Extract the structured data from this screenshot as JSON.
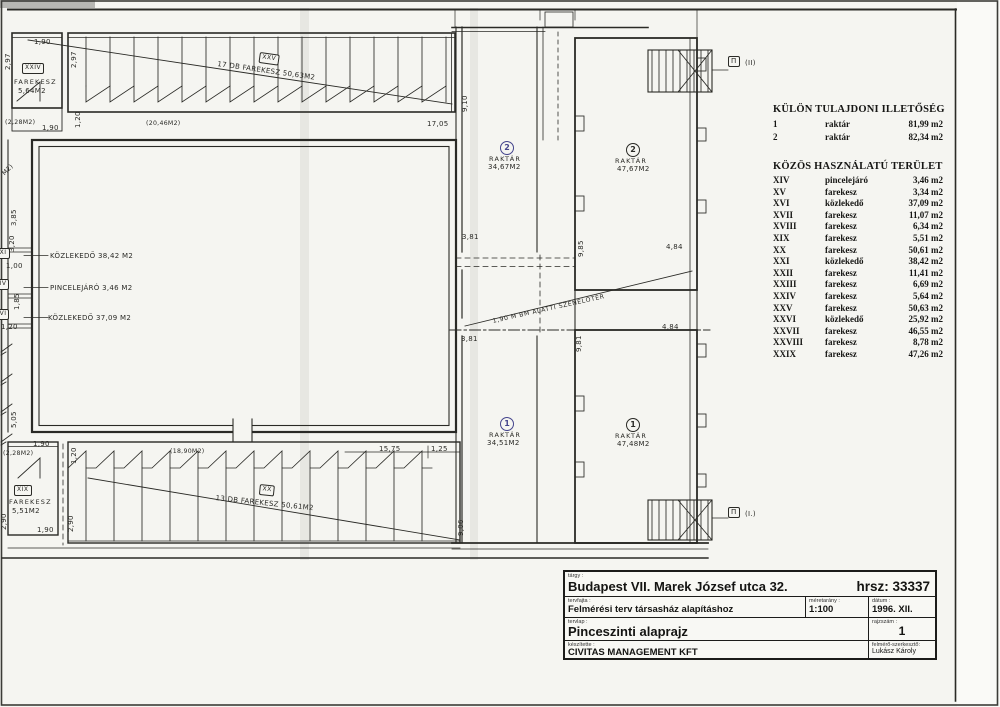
{
  "colors": {
    "paper": "#f5f5f1",
    "ink": "#2a2a26",
    "blue_ink": "#44448c"
  },
  "plan": {
    "dims": {
      "tl_297a": "2,97",
      "tl_190a": "1,90",
      "tl_297b": "2,97",
      "tl_120": "1,20",
      "tl_228": "(2,28M2)",
      "tl_190b": "1,90",
      "tl_2046": "(20,46M2)",
      "tl_1705": "17,05",
      "lm_385": "3,85",
      "lm_320": "3,20",
      "lm_100": "1,00",
      "lm_185": "1,85",
      "lm_120": "1,20",
      "lm_505": "5,05",
      "lm_part": "M2)",
      "bl_190a": "1,90",
      "bl_228": "(2,28M2)",
      "bl_120": "1,20",
      "bl_290a": "2,90",
      "bl_190b": "1,90",
      "bl_290b": "2,90",
      "bl_1890": "(18,90M2)",
      "bl_1575": "15,75",
      "bl_125": "1,25",
      "m_910": "9,10",
      "m_381a": "3,81",
      "m_985": "9,85",
      "m_484a": "4,84",
      "m_381b": "3,81",
      "m_981": "9,81",
      "m_484b": "4,84",
      "m_906": "9,06"
    },
    "rooms": {
      "xxiv": {
        "id": "XXIV",
        "name": "FAREKESZ",
        "area": "5,64M2"
      },
      "xxv": {
        "id": "XXV",
        "label": "17 DB FAREKESZ 50,63M2"
      },
      "xix": {
        "id": "XIX",
        "name": "FAREKESZ",
        "area": "5,51M2"
      },
      "xx": {
        "id": "XX",
        "label": "13 DB FAREKESZ 50,61M2"
      },
      "xxi": {
        "id": "XXI",
        "label": "KÖZLEKEDŐ 38,42 M2"
      },
      "xiv": {
        "id": "XIV",
        "label": "PINCELEJÁRÓ 3,46 M2"
      },
      "xvi": {
        "id": "XVI",
        "label": "KÖZLEKEDŐ 37,09 M2"
      },
      "rak2a": {
        "num": "2",
        "name": "RAKTÁR",
        "area": "34,67M2"
      },
      "rak2b": {
        "num": "2",
        "name": "RAKTÁR",
        "area": "47,67M2"
      },
      "rak1a": {
        "num": "1",
        "name": "RAKTÁR",
        "area": "34,51M2"
      },
      "rak1b": {
        "num": "1",
        "name": "RAKTÁR",
        "area": "47,48M2"
      },
      "coal": "1,90 M BM ALATTI SZENELŐTÉR",
      "stair_top": {
        "flag": "Π",
        "num": "(II)"
      },
      "stair_bottom": {
        "flag": "Π",
        "num": "(I.)"
      }
    }
  },
  "tables": {
    "kulon": {
      "title": "KÜLÖN TULAJDONI ILLETŐSÉG",
      "rows": [
        {
          "num": "1",
          "name": "raktár",
          "area": "81,99 m2"
        },
        {
          "num": "2",
          "name": "raktár",
          "area": "82,34 m2"
        }
      ]
    },
    "kozos": {
      "title": "KÖZÖS HASZNÁLATÚ TERÜLET",
      "rows": [
        {
          "num": "XIV",
          "name": "pincelejáró",
          "area": "3,46 m2"
        },
        {
          "num": "XV",
          "name": "farekesz",
          "area": "3,34 m2"
        },
        {
          "num": "XVI",
          "name": "közlekedő",
          "area": "37,09 m2"
        },
        {
          "num": "XVII",
          "name": "farekesz",
          "area": "11,07 m2"
        },
        {
          "num": "XVIII",
          "name": "farekesz",
          "area": "6,34 m2"
        },
        {
          "num": "XIX",
          "name": "farekesz",
          "area": "5,51 m2"
        },
        {
          "num": "XX",
          "name": "farekesz",
          "area": "50,61 m2"
        },
        {
          "num": "XXI",
          "name": "közlekedő",
          "area": "38,42 m2"
        },
        {
          "num": "XXII",
          "name": "farekesz",
          "area": "11,41 m2"
        },
        {
          "num": "XXIII",
          "name": "farekesz",
          "area": "6,69 m2"
        },
        {
          "num": "XXIV",
          "name": "farekesz",
          "area": "5,64 m2"
        },
        {
          "num": "XXV",
          "name": "farekesz",
          "area": "50,63 m2"
        },
        {
          "num": "XXVI",
          "name": "közlekedő",
          "area": "25,92 m2"
        },
        {
          "num": "XXVII",
          "name": "farekesz",
          "area": "46,55 m2"
        },
        {
          "num": "XXVIII",
          "name": "farekesz",
          "area": "8,78 m2"
        },
        {
          "num": "XXIX",
          "name": "farekesz",
          "area": "47,26 m2"
        }
      ]
    }
  },
  "titleblock": {
    "targy_label": "tárgy :",
    "targy": "Budapest VII. Marek József utca 32.",
    "hrsz": "hrsz: 33337",
    "tervfajta_label": "tervfajta :",
    "tervfajta": "Felmérési terv társasház alapításhoz",
    "meretarany_label": "méretarány :",
    "meretarany": "1:100",
    "datum_label": "dátum :",
    "datum": "1996. XII.",
    "tervlap_label": "tervlap :",
    "tervlap": "Pinceszinti alaprajz",
    "rajzszam_label": "rajzszám :",
    "rajzszam": "1",
    "keszitette_label": "készítette :",
    "keszitette": "CIVITAS MANAGEMENT KFT",
    "felmero_label": "felmérő-szerkesztő:",
    "felmero": "Lukász Károly"
  }
}
